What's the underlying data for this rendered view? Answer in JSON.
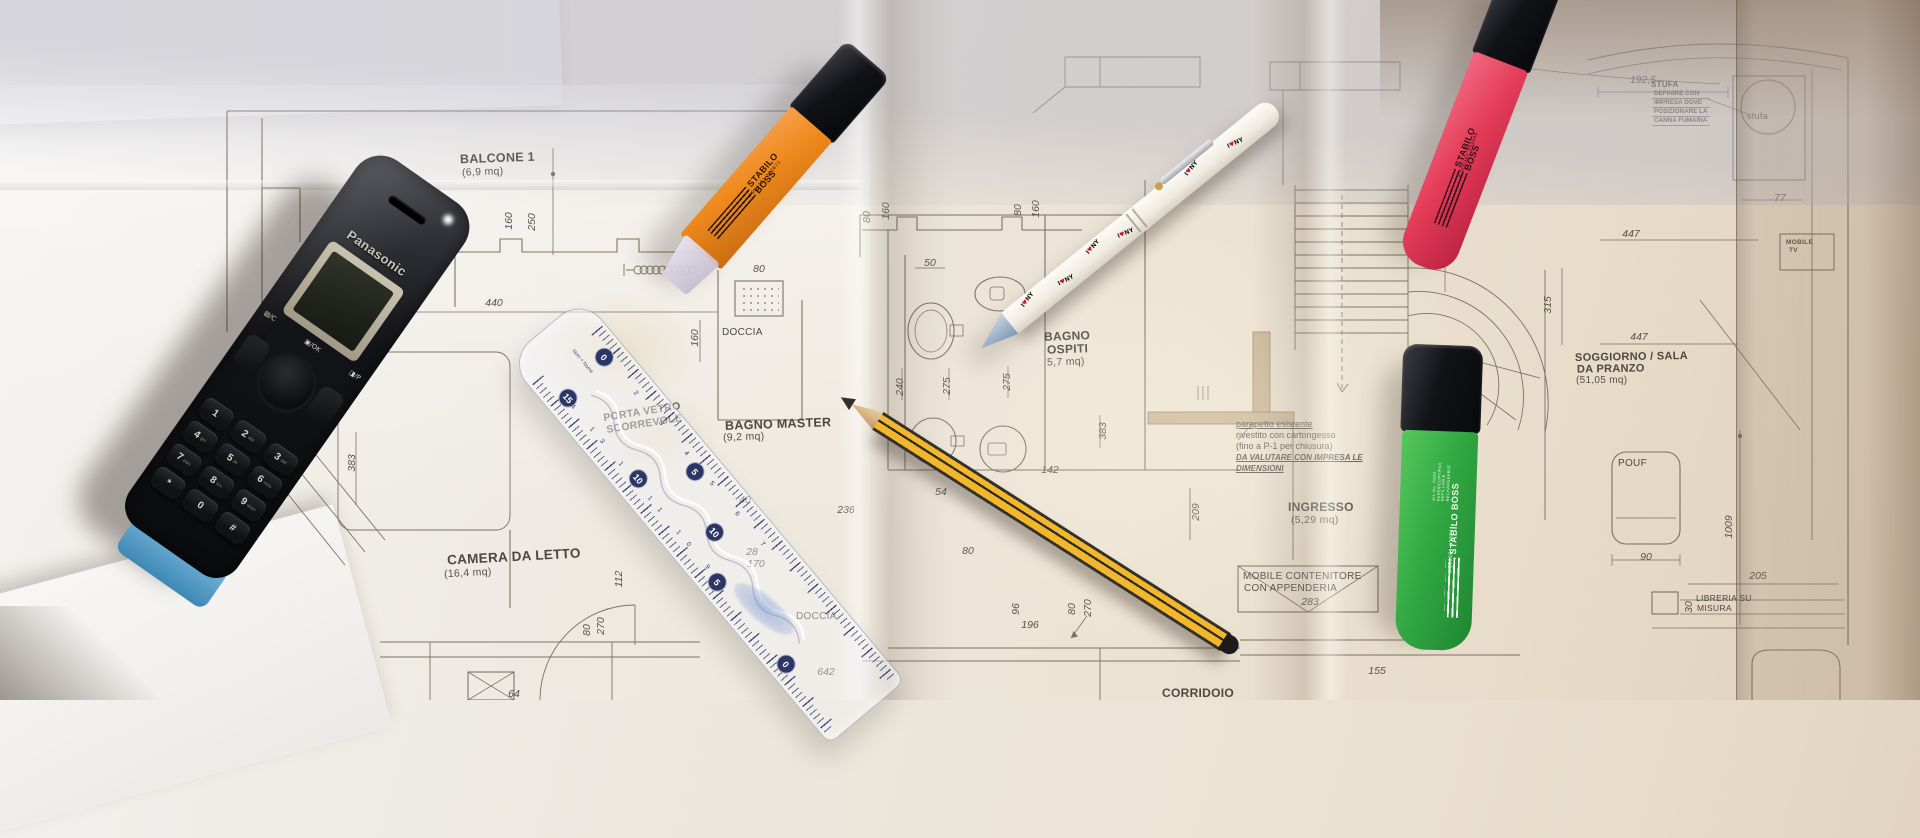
{
  "scene": {
    "kind": "photograph",
    "subject": "Italian apartment floor-plan drawings on a desk with cordless phone, highlighters, pen, pencil and ruler"
  },
  "blueprint": {
    "rooms": [
      {
        "name": "BALCONE 1",
        "area": "(6,9 mq)"
      },
      {
        "name": "CAMERA DA LETTO",
        "area": "(16,4 mq)"
      },
      {
        "name": "BAGNO MASTER",
        "area": "(9,2 mq)"
      },
      {
        "name": "BAGNO",
        "name2": "OSPITI",
        "area": "5,7 mq)"
      },
      {
        "name": "INGRESSO",
        "area": "(5,29 mq)"
      },
      {
        "name": "SOGGIORNO / SALA",
        "name2": "DA PRANZO",
        "area": "(51,05 mq)"
      },
      {
        "name": "CORRIDOIO",
        "area": ""
      }
    ],
    "labels": {
      "doccia1": "DOCCIA",
      "doccia2": "DOCCIA",
      "mobile_tv1": "MOBILE",
      "mobile_tv2": "TV",
      "pouf": "POUF",
      "libreria1": "LIBRERIA SU",
      "libreria2": "MISURA",
      "mobile_cont1": "MOBILE CONTENITORE",
      "mobile_cont2": "CON APPENDERIA",
      "porta1": "PORTA VETRO",
      "porta2": "SCORREVOLE",
      "stufa_small": "stufa"
    },
    "notes": {
      "stufa": [
        "STUFA",
        "DEFINIRE CON",
        "IMPRESA DOVE",
        "POSIZIONARE LA",
        "CANNA FUMARIA"
      ],
      "parapetto": [
        "parapetto esistente",
        "rivestito con cartongesso",
        "(fino a P-1 per chiusura)",
        "DA VALUTARE CON IMPRESA LE",
        "DIMENSIONI"
      ]
    },
    "dims": [
      "160",
      "250",
      "440",
      "80",
      "160",
      "80",
      "160",
      "80",
      "160",
      "50",
      "240",
      "275",
      "275",
      "383",
      "105",
      "236",
      "54",
      "142",
      "40",
      "28",
      "170",
      "112",
      "80",
      "270",
      "64",
      "642",
      "383",
      "209",
      "96",
      "196",
      "80",
      "270",
      "80",
      "283",
      "155",
      "100",
      "290",
      "192,5",
      "77",
      "447",
      "365",
      "315",
      "1009",
      "90",
      "205",
      "30",
      "447"
    ]
  },
  "objects": {
    "phone": {
      "brand": "Panasonic",
      "softkeys": [
        "▤/C",
        "▣/OK",
        "◨/P"
      ],
      "keys": [
        [
          "1",
          ""
        ],
        [
          "2",
          "abc"
        ],
        [
          "3",
          "def"
        ],
        [
          "4",
          "ghi"
        ],
        [
          "5",
          "jkl"
        ],
        [
          "6",
          "mno"
        ],
        [
          "7",
          "pqrs"
        ],
        [
          "8",
          "tuv"
        ],
        [
          "9",
          "wxyz"
        ],
        [
          "*",
          ""
        ],
        [
          "0",
          ""
        ],
        [
          "#",
          ""
        ]
      ]
    },
    "marker_orange": {
      "brand": "STABILO BOSS",
      "barcode": "4 006381 333672"
    },
    "marker_pink": {
      "brand": "STABILO BOSS",
      "barcode": "4 006381 333689"
    },
    "marker_green": {
      "brand": "STABILO BOSS",
      "barcode": "4 006381 333641",
      "micro": "Art.-No. 70/33 PAPER/COPY/FAX REFILLABLE RECHARGEABLE"
    },
    "pen": {
      "p1": "I",
      "p2": "♥",
      "p3": "NY"
    },
    "ruler": {
      "badges": [
        "0",
        "15",
        "5",
        "10",
        "10",
        "5",
        "0"
      ],
      "micro": "Nom + Name",
      "scale_top": "1 2 3 4 5 6 7",
      "scale_bottom": "14 13 12 11 10 9"
    }
  }
}
